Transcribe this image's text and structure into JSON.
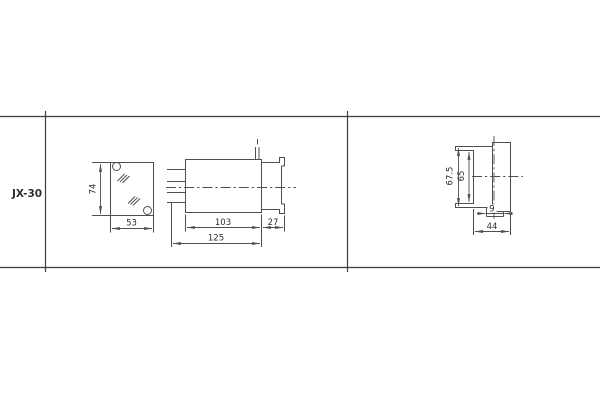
{
  "colors": {
    "background": "#ffffff",
    "line": "#4f4f4f",
    "frame": "#3d3d3d",
    "text": "#2e2e2e"
  },
  "drawing": {
    "model": "JX-30",
    "front": {
      "height": "74",
      "width": "53"
    },
    "side": {
      "body_length": "103",
      "flange_depth": "27",
      "overall_length": "125"
    },
    "rear": {
      "outer_height": "67.5",
      "inner_height": "65",
      "slot_width": "9",
      "overall_width": "44"
    }
  }
}
